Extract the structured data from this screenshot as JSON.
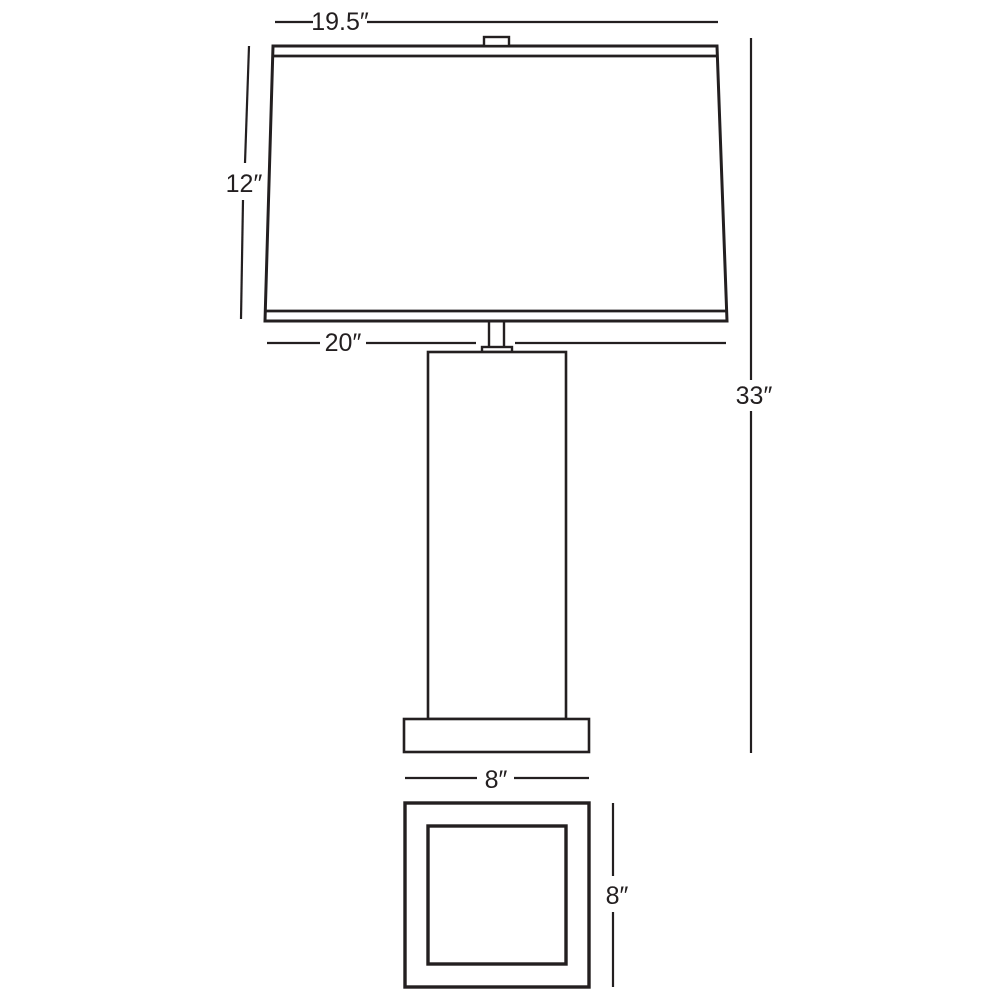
{
  "diagram": {
    "name": "table-lamp-dimension-diagram",
    "unit": "inches",
    "colors": {
      "line": "#231f20",
      "background": "#ffffff"
    },
    "labels": {
      "shade_top_width": "19.5″",
      "shade_height": "12″",
      "shade_bottom_width": "20″",
      "overall_height": "33″",
      "base_width": "8″",
      "base_depth": "8″"
    }
  }
}
